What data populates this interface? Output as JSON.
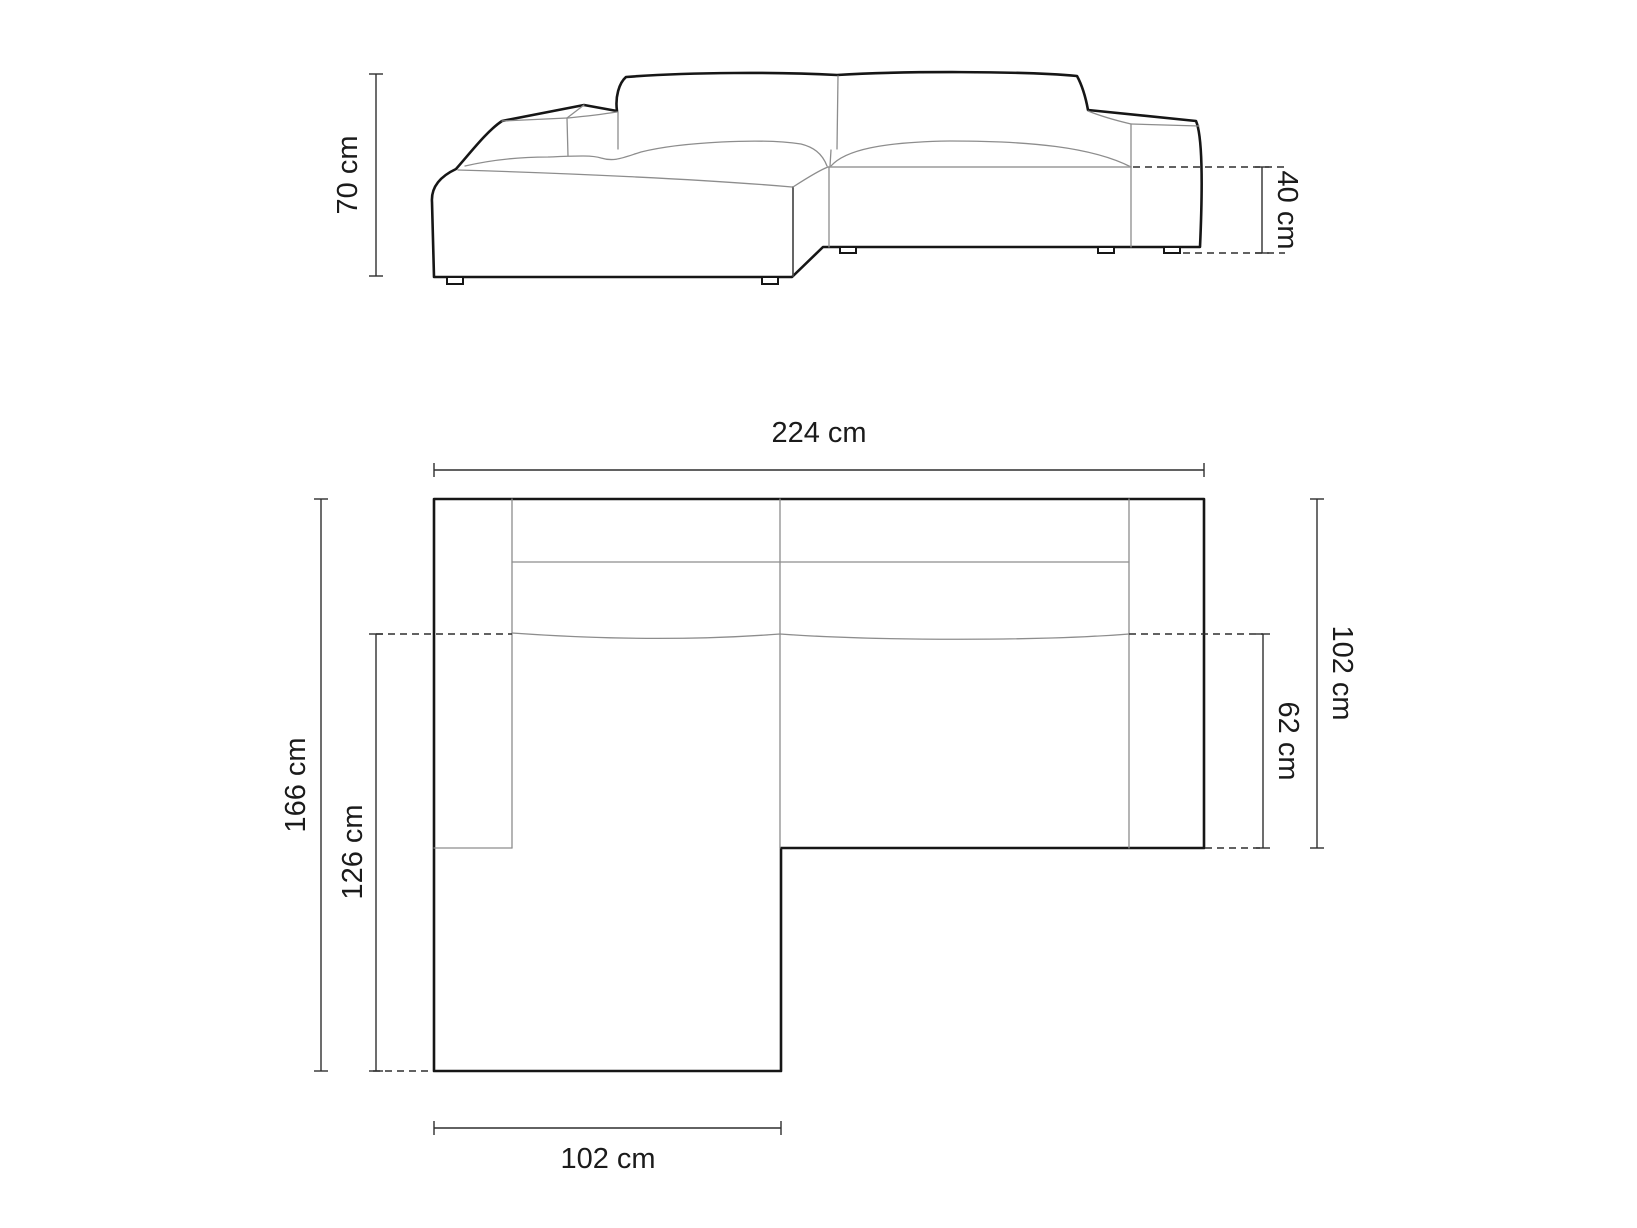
{
  "colors": {
    "outline": "#161616",
    "detail": "#8d8d8d",
    "detail-dark": "#4a4a4a",
    "dimension": "#2f2f2f",
    "text": "#1b1b1b",
    "background": "#ffffff"
  },
  "front_view": {
    "height_label": "70 cm",
    "seat_height_label": "40 cm"
  },
  "top_view": {
    "width_label": "224 cm",
    "depth_label": "166 cm",
    "chaise_inner_depth_label": "126 cm",
    "right_depth_label": "102 cm",
    "seat_depth_label": "62 cm",
    "chaise_width_label": "102 cm"
  }
}
